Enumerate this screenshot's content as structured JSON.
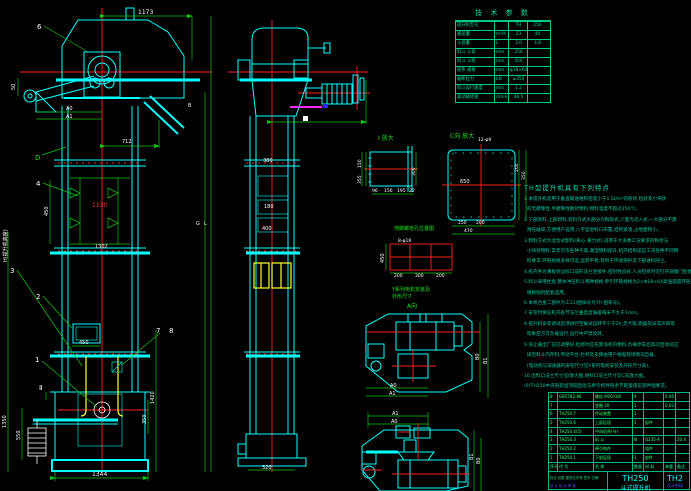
{
  "colors": {
    "cyan": "#00ffff",
    "red": "#ff2222",
    "green": "#12c412",
    "teal": "#00d99a",
    "white": "#ffffff",
    "yellow": "#ffff33",
    "magenta": "#ff2aff",
    "blue": "#5555ff",
    "background": "#000000"
  },
  "tech_table": {
    "title": "技 术 参 数",
    "rows": [
      {
        "label": "提升机型号",
        "unit": "",
        "v1": "TH",
        "v2": "250"
      },
      {
        "label": "输送量",
        "unit": "m³/h",
        "v1": "23",
        "v2": "40"
      },
      {
        "label": "斗容量",
        "unit": "L",
        "v1": "3.0",
        "v2": "4.8"
      },
      {
        "label": "料斗 斗宽",
        "unit": "mm",
        "v1": "250",
        "v2": ""
      },
      {
        "label": "料斗 斗距",
        "unit": "mm",
        "v1": "450",
        "v2": ""
      },
      {
        "label": "链条 规格",
        "unit": "mm",
        "v1": "φ18×64",
        "v2": ""
      },
      {
        "label": "破断拉力",
        "unit": "kN",
        "v1": "≥250",
        "v2": ""
      },
      {
        "label": "料斗运行速度",
        "unit": "m/s",
        "v1": "1.2",
        "v2": ""
      },
      {
        "label": "驱动轴转速",
        "unit": "r/min",
        "v1": "48.5",
        "v2": ""
      }
    ]
  },
  "notes": {
    "title": "TH型提升机具有下列特点",
    "lines": [
      "1.本提升机适用于垂直输送堆积密度小于1.5t/m³的粉状,粒状及小块状",
      "  的无磨琢性,半磨琢性散状物料,物料温度不超过250℃。",
      "2.下部装料,上部卸料,装料方式大部分为掏取式,少量为流入式,一大部分不需",
      "  预先破碎,方便用户选用,八字型进料口布置,结构紧凑,占地面积小。",
      "3.卸料方式为混合式卸料(离心-重力式),适用于大多数工况要求的粉状与",
      "  小块状物料,常年可作各种干燥,潮湿物料提升,机壳结构适应工况各种不同物",
      "  料要求,环链规格多样可选,运转平稳,有利于环境保护及下部进料除尘。",
      "4.机壳件为薄板折边咬口成形法兰连接件,密封性良好,人员检修时可打开观察门检修除尘",
      "5.料斗采用栓接,整体冲压料斗两种规格,牵引环链规格为2×Φ18×64高强度圆环链,",
      "  规格随机配套选用。",
      "6.本机合金二部件为工11(图样号为TH 图系号)。",
      "7.安装时保证机壳各节法兰垂直度偏差每米不大于1mm。",
      "8.提升机安装调试后须进行空载试运转不少于2h,无卡链,跑偏及异常声响等",
      "  现象后方可负载运行,运行中严禁反转。",
      "9.逆止器出厂前已调整好,检修时应先卸净机内物料,负载停车后再次启动前应",
      "  排空料斗内存料,传动平台,栏杆及支撑由用户根据现场情况自备。",
      "  (电动机与减速器的安装尺寸见Y系列电机安装及外形尺寸表)。",
      "10.出料口法兰尺寸见Ⅰ放大图,进料口法兰尺寸见C向放大图。",
      "(9)TH250中央链轮齿顶圆直径与牵引构件链条节距差值见部件图要求。"
    ]
  },
  "bom": {
    "header": [
      "序号",
      "代 号",
      "名 称",
      "数量",
      "材 料",
      "单重",
      "备注"
    ],
    "rows": [
      [
        "8",
        "GB5782-86",
        "螺栓 M20×80",
        "4",
        "",
        "0.06",
        ""
      ],
      [
        "7",
        "",
        "垫圈 20",
        "1",
        "",
        "0.03",
        ""
      ],
      [
        "6",
        "TH250.7",
        "传动装置",
        "1",
        "",
        "",
        ""
      ],
      [
        "5",
        "TH250.6",
        "上部区段",
        "1",
        "部件",
        "",
        ""
      ],
      [
        "4",
        "TH250.4(5)",
        "中间机壳(节)",
        "",
        "",
        "",
        ""
      ],
      [
        "3",
        "TH250.3",
        "料 斗",
        "N",
        "Q235-A",
        "",
        "20.4"
      ],
      [
        "2",
        "TH250.2",
        "牵引构件",
        "",
        "组件",
        "",
        ""
      ],
      [
        "1",
        "TH250.1",
        "下部区段",
        "1",
        "部件",
        "",
        ""
      ]
    ]
  },
  "title_block": {
    "model": "TH250",
    "product": "斗式提升机",
    "doc_no": "TH2",
    "stage": "设计阶段",
    "rev_row": "标记 处数 更改文件号 签字 日期",
    "sign_row": "设 计  校 对  审 核",
    "approve_row": "工 艺  批 准  日 期"
  },
  "labels": {
    "balloon_1": "1",
    "balloon_2": "2",
    "balloon_3": "3",
    "balloon_4": "4",
    "balloon_6": "6",
    "balloon_7": "7",
    "balloon_8": "8",
    "section_d": "D",
    "section_b": "B",
    "section_ii": "Ⅱ",
    "detail_i": "Ⅰ 放大",
    "detail_c": "C向 放大",
    "detail_c_note": "12-φ9",
    "view_a": "A向",
    "anchor_caption": "地脚螺栓孔位置图",
    "anchor_holes": "8-φ18",
    "motor_note_1": "Y系列电机安装及",
    "motor_note_2": "外形尺寸",
    "height_label": "H(提升机高度)",
    "dim_g": "G",
    "dim_l": "L"
  },
  "dims": {
    "d1173": "1173",
    "d712": "712",
    "a0": "A0",
    "a1": "A1",
    "d50": "50",
    "d450v": "450",
    "d1130": "1130",
    "d1302": "1302",
    "d450b": "450",
    "d1344": "1344",
    "d1350": "1350",
    "d550": "550",
    "d1420": "1420",
    "d350": "350",
    "m380": "380",
    "m180": "180",
    "m400": "400",
    "m320": "320",
    "i96": "96",
    "i156": "156",
    "i195": "195",
    "i22": "22",
    "i150": "150",
    "i355": "355",
    "i300": "300",
    "c650": "650",
    "c250": "250",
    "c200": "200",
    "c470": "470",
    "cr200": "200",
    "cr350": "350",
    "g450": "450",
    "g200a": "200",
    "g300": "300",
    "g200b": "200",
    "tv1_a0": "A0",
    "tv1_a1": "A1",
    "tv1_b0": "B0",
    "tv1_b1": "B1",
    "tv2_a0": "A0",
    "tv2_a1": "A1",
    "tv2_b0": "B0",
    "tv2_b1": "B1"
  }
}
